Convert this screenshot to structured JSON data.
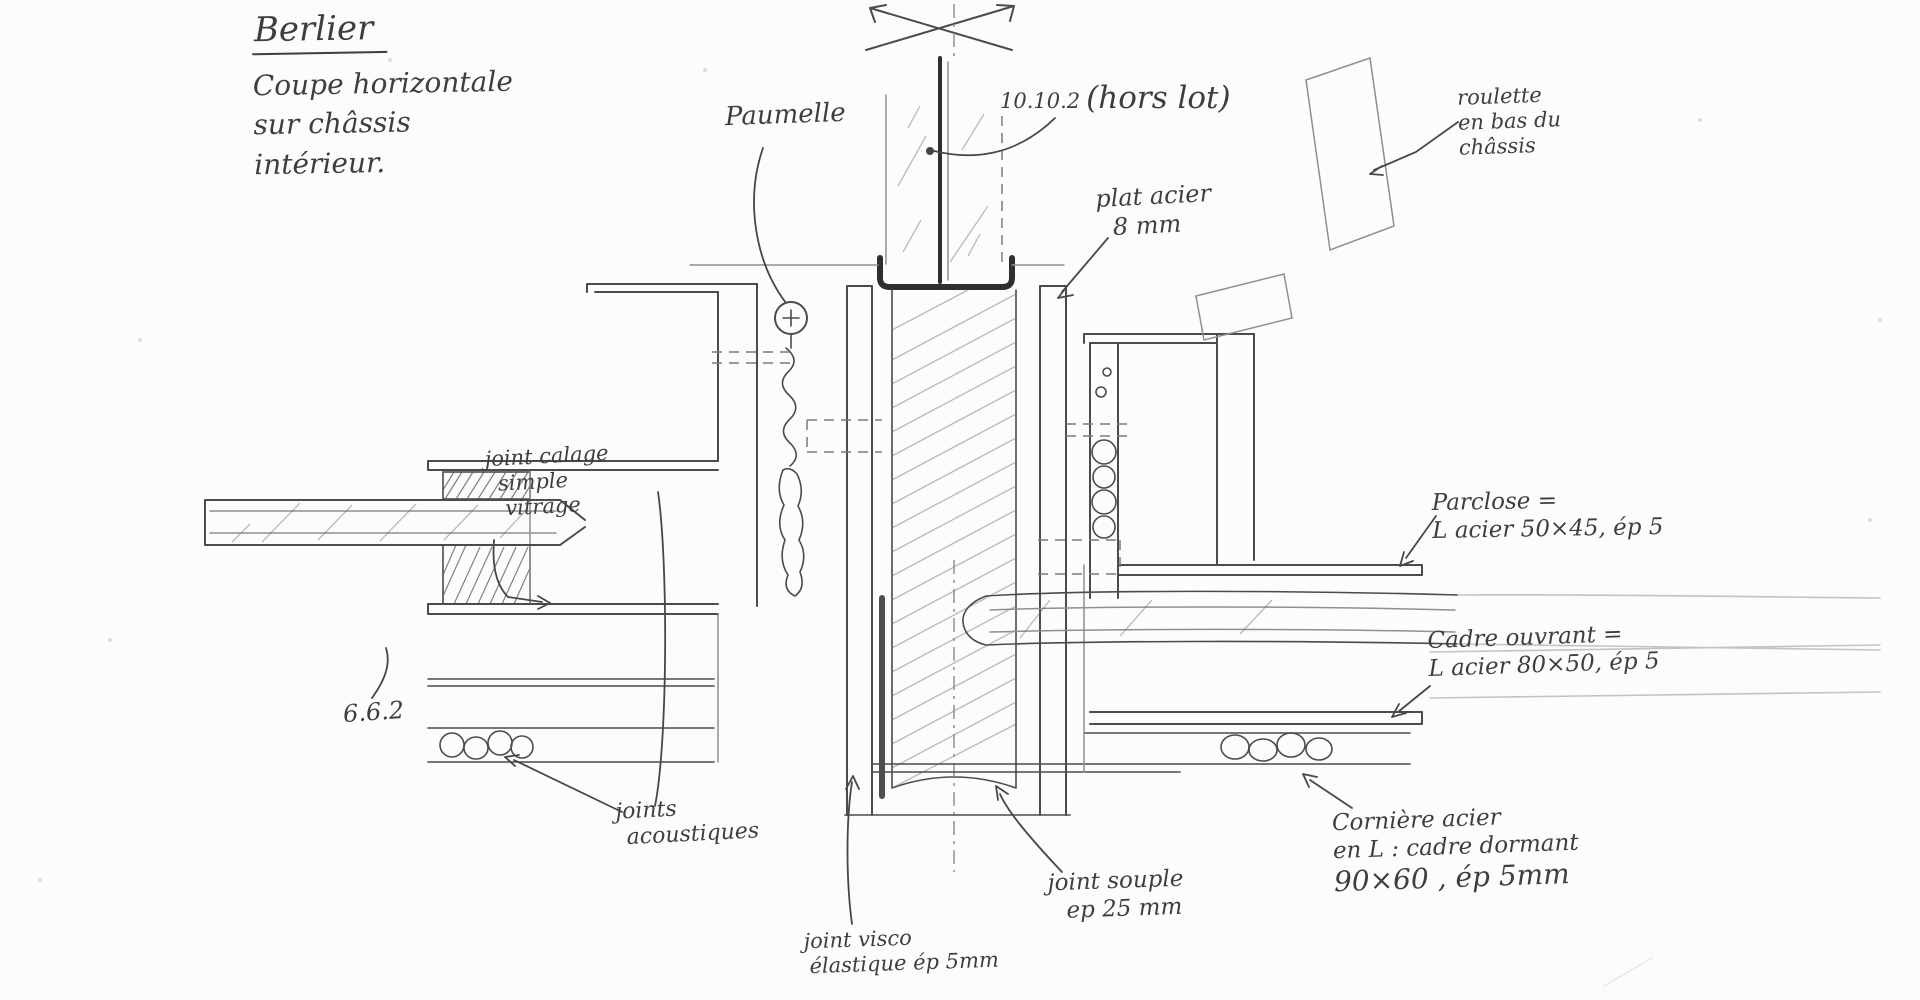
{
  "page": {
    "background": "#fcfcfc",
    "pencil_color": "#4b4b4b"
  },
  "title_block": {
    "name": "Berlier",
    "line1": "Coupe horizontale",
    "line2": "sur châssis",
    "line3": "intérieur."
  },
  "annotations": {
    "paumelle": "Paumelle",
    "glazing_ref": "10.10.2",
    "glazing_ref_suffix": "(hors lot)",
    "plat_acier_l1": "plat acier",
    "plat_acier_l2": "8 mm",
    "roulette_l1": "roulette",
    "roulette_l2": "en bas du",
    "roulette_l3": "châssis",
    "joint_calage_l1": "joint calage",
    "joint_calage_l2": "simple",
    "joint_calage_l3": "vitrage",
    "pane_ref": "6.6.2",
    "parclose_l1": "Parclose =",
    "parclose_l2": "L acier 50×45, ép 5",
    "cadre_ouvrant_l1": "Cadre ouvrant =",
    "cadre_ouvrant_l2": "L acier 80×50, ép 5",
    "joints_acoustiques_l1": "joints",
    "joints_acoustiques_l2": "acoustiques",
    "joint_visco_l1": "joint visco",
    "joint_visco_l2": "élastique ép 5mm",
    "joint_souple_l1": "joint souple",
    "joint_souple_l2": "ep 25 mm",
    "corniere_l1": "Cornière acier",
    "corniere_l2": "en L : cadre dormant",
    "corniere_l3": "90×60 , ép 5mm"
  }
}
